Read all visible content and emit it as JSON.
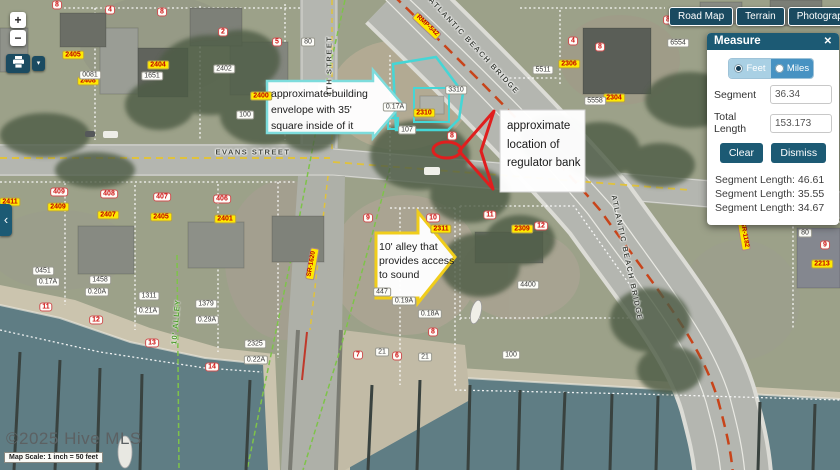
{
  "controls": {
    "zoom_in": "+",
    "zoom_out": "−",
    "print_caret": "▾",
    "collapse_chevron": "‹"
  },
  "map_type_buttons": [
    {
      "label": "Road Map"
    },
    {
      "label": "Terrain"
    },
    {
      "label": "Photography"
    },
    {
      "label": "▾"
    }
  ],
  "measure_panel": {
    "title": "Measure",
    "close": "✕",
    "units": [
      {
        "label": "Feet",
        "selected": true
      },
      {
        "label": "Miles",
        "selected": false
      }
    ],
    "fields": [
      {
        "label": "Segment",
        "value": "36.34"
      },
      {
        "label": "Total Length",
        "value": "153.173"
      }
    ],
    "buttons": [
      "Clear",
      "Dismiss"
    ],
    "segments": [
      "Segment Length: 46.61",
      "Segment Length: 35.55",
      "Segment Length: 34.67"
    ]
  },
  "callouts": [
    {
      "id": "building-envelope",
      "text": "approximate building envelope with 35' square inside of it"
    },
    {
      "id": "regulator-bank",
      "text": "approximate location of regulator bank"
    },
    {
      "id": "alley",
      "text": "10' alley that provides access to sound"
    }
  ],
  "attribution": {
    "copyright": "©2025 Hive MLS",
    "scale": "Map Scale: 1 inch = 50 feet"
  },
  "colors": {
    "panel_teal": "#1c5a74",
    "button_navy": "#1a4a60",
    "feet_selected_bg": "#a9d0e4",
    "miles_bg": "#4792c2",
    "parcel_label_yellow": "#ffe900",
    "parcel_label_red_text": "#c00000",
    "envelope_cyan": "#45d6d6",
    "annotation_red": "#e01e1e",
    "alley_arrow_yellow": "#f0cd1b"
  },
  "map_labels": [
    {
      "t": "EVANS STREET",
      "k": "street",
      "x": 253,
      "y": 152
    },
    {
      "t": "4TH STREET",
      "k": "street",
      "x": 329,
      "y": 66,
      "r": -90
    },
    {
      "t": "ATLANTIC BEACH BRIDGE",
      "k": "street",
      "x": 474,
      "y": 46,
      "r": 47
    },
    {
      "t": "ATLANTIC BEACH BRIDGE",
      "k": "street",
      "x": 627,
      "y": 258,
      "r": 78
    },
    {
      "t": "SOUTH",
      "k": "street",
      "x": 749,
      "y": 200,
      "r": 90
    },
    {
      "t": "10' ALLEY",
      "k": "green",
      "x": 176,
      "y": 322,
      "r": -85
    },
    {
      "t": "EVANS",
      "k": "white",
      "x": 818,
      "y": 191,
      "r": -10
    },
    {
      "t": "STREET",
      "k": "white",
      "x": 819,
      "y": 201,
      "r": -10
    },
    {
      "t": "RMP-542",
      "k": "route",
      "x": 427,
      "y": 26,
      "r": 43
    },
    {
      "t": "SR-1182",
      "k": "route",
      "x": 744,
      "y": 235,
      "r": 80
    },
    {
      "t": "SR-1620",
      "k": "route",
      "x": 312,
      "y": 264,
      "r": -80
    },
    {
      "t": "2405",
      "k": "yellow",
      "x": 73,
      "y": 55
    },
    {
      "t": "2408",
      "k": "yellow",
      "x": 88,
      "y": 81
    },
    {
      "t": "2404",
      "k": "yellow",
      "x": 158,
      "y": 65
    },
    {
      "t": "2400",
      "k": "yellow",
      "x": 261,
      "y": 96
    },
    {
      "t": "2310",
      "k": "yellow",
      "x": 424,
      "y": 113
    },
    {
      "t": "2311",
      "k": "yellow",
      "x": 441,
      "y": 229
    },
    {
      "t": "2309",
      "k": "yellow",
      "x": 522,
      "y": 229
    },
    {
      "t": "2306",
      "k": "yellow",
      "x": 569,
      "y": 64
    },
    {
      "t": "2304",
      "k": "yellow",
      "x": 614,
      "y": 98
    },
    {
      "t": "2213",
      "k": "yellow",
      "x": 822,
      "y": 264
    },
    {
      "t": "2411",
      "k": "yellow",
      "x": 10,
      "y": 202
    },
    {
      "t": "2409",
      "k": "yellow",
      "x": 58,
      "y": 207
    },
    {
      "t": "2407",
      "k": "yellow",
      "x": 108,
      "y": 215
    },
    {
      "t": "2405",
      "k": "yellow",
      "x": 161,
      "y": 217
    },
    {
      "t": "2401",
      "k": "yellow",
      "x": 225,
      "y": 219
    },
    {
      "t": "0081",
      "k": "white",
      "x": 90,
      "y": 75
    },
    {
      "t": "1651",
      "k": "white",
      "x": 152,
      "y": 76
    },
    {
      "t": "2402",
      "k": "white",
      "x": 224,
      "y": 69
    },
    {
      "t": "100",
      "k": "white",
      "x": 245,
      "y": 115
    },
    {
      "t": "0.17A",
      "k": "white",
      "x": 395,
      "y": 107
    },
    {
      "t": "107",
      "k": "white",
      "x": 407,
      "y": 130
    },
    {
      "t": "3310",
      "k": "white",
      "x": 456,
      "y": 90
    },
    {
      "t": "5511",
      "k": "white",
      "x": 543,
      "y": 70
    },
    {
      "t": "5558",
      "k": "white",
      "x": 595,
      "y": 101
    },
    {
      "t": "6554",
      "k": "white",
      "x": 678,
      "y": 43
    },
    {
      "t": "6557",
      "k": "white",
      "x": 826,
      "y": 113
    },
    {
      "t": "0451",
      "k": "white",
      "x": 43,
      "y": 271
    },
    {
      "t": "0.17A",
      "k": "white",
      "x": 48,
      "y": 282
    },
    {
      "t": "1458",
      "k": "white",
      "x": 100,
      "y": 280
    },
    {
      "t": "0.20A",
      "k": "white",
      "x": 97,
      "y": 292
    },
    {
      "t": "1311",
      "k": "white",
      "x": 149,
      "y": 296
    },
    {
      "t": "0.21A",
      "k": "white",
      "x": 148,
      "y": 311
    },
    {
      "t": "1379",
      "k": "white",
      "x": 206,
      "y": 304
    },
    {
      "t": "0.29A",
      "k": "white",
      "x": 207,
      "y": 320
    },
    {
      "t": "2325",
      "k": "white",
      "x": 255,
      "y": 344
    },
    {
      "t": "0.22A",
      "k": "white",
      "x": 256,
      "y": 360
    },
    {
      "t": "447",
      "k": "white",
      "x": 382,
      "y": 292
    },
    {
      "t": "0.19A",
      "k": "white",
      "x": 404,
      "y": 301
    },
    {
      "t": "0.18A",
      "k": "white",
      "x": 430,
      "y": 314
    },
    {
      "t": "4400",
      "k": "white",
      "x": 528,
      "y": 285
    },
    {
      "t": "100",
      "k": "white",
      "x": 511,
      "y": 355
    },
    {
      "t": "80",
      "k": "white",
      "x": 308,
      "y": 42
    },
    {
      "t": "80",
      "k": "white",
      "x": 805,
      "y": 233
    },
    {
      "t": "21",
      "k": "white",
      "x": 382,
      "y": 352
    },
    {
      "t": "21",
      "k": "white",
      "x": 425,
      "y": 357
    },
    {
      "t": "409",
      "k": "red",
      "x": 59,
      "y": 192
    },
    {
      "t": "408",
      "k": "red",
      "x": 109,
      "y": 194
    },
    {
      "t": "407",
      "k": "red",
      "x": 162,
      "y": 197
    },
    {
      "t": "406",
      "k": "red",
      "x": 222,
      "y": 199
    },
    {
      "t": "4",
      "k": "red",
      "x": 110,
      "y": 10
    },
    {
      "t": "8",
      "k": "red",
      "x": 162,
      "y": 12
    },
    {
      "t": "2",
      "k": "red",
      "x": 223,
      "y": 32
    },
    {
      "t": "5",
      "k": "red",
      "x": 277,
      "y": 42
    },
    {
      "t": "8",
      "k": "red",
      "x": 57,
      "y": 5
    },
    {
      "t": "4",
      "k": "red",
      "x": 573,
      "y": 41
    },
    {
      "t": "8",
      "k": "red",
      "x": 600,
      "y": 47
    },
    {
      "t": "8",
      "k": "red",
      "x": 668,
      "y": 20
    },
    {
      "t": "9",
      "k": "red",
      "x": 368,
      "y": 218
    },
    {
      "t": "10",
      "k": "red",
      "x": 433,
      "y": 218
    },
    {
      "t": "11",
      "k": "red",
      "x": 490,
      "y": 215
    },
    {
      "t": "12",
      "k": "red",
      "x": 541,
      "y": 226
    },
    {
      "t": "11",
      "k": "red",
      "x": 46,
      "y": 307
    },
    {
      "t": "12",
      "k": "red",
      "x": 96,
      "y": 320
    },
    {
      "t": "13",
      "k": "red",
      "x": 152,
      "y": 343
    },
    {
      "t": "14",
      "k": "red",
      "x": 212,
      "y": 367
    },
    {
      "t": "8",
      "k": "red",
      "x": 433,
      "y": 332
    },
    {
      "t": "7",
      "k": "red",
      "x": 358,
      "y": 355
    },
    {
      "t": "6",
      "k": "red",
      "x": 397,
      "y": 356
    },
    {
      "t": "9",
      "k": "red",
      "x": 825,
      "y": 245
    },
    {
      "t": "8",
      "k": "red",
      "x": 452,
      "y": 136
    }
  ]
}
